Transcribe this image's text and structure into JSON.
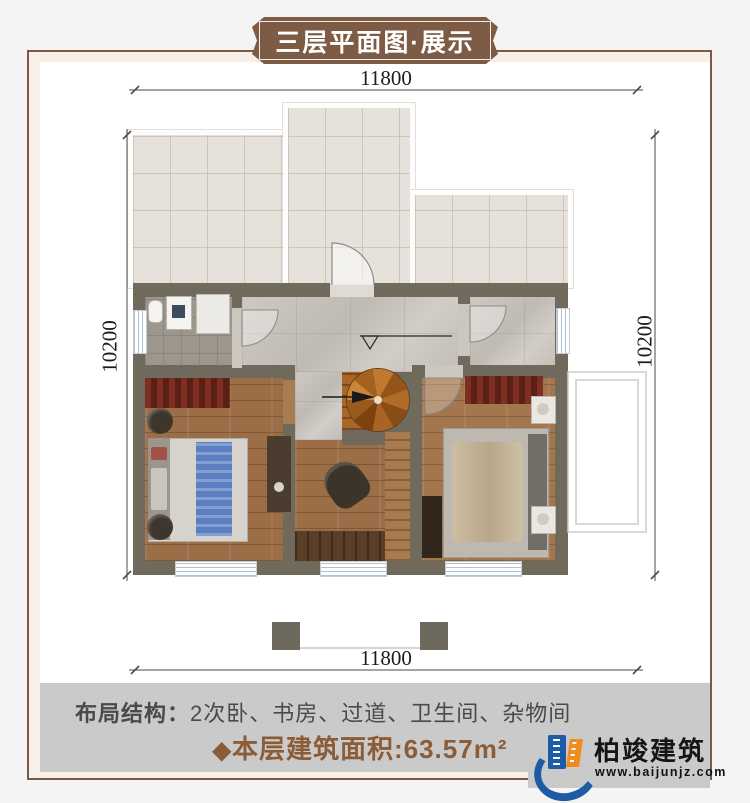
{
  "banner": {
    "title": "三层平面图·展示"
  },
  "dimensions": {
    "top": "11800",
    "bottom": "11800",
    "left": "10200",
    "right": "10200"
  },
  "plan": {
    "elevation": "6.900",
    "stair_label": "下",
    "rooms": [
      {
        "id": "terrace",
        "label": "露台"
      },
      {
        "id": "bathroom",
        "label": "公卫"
      },
      {
        "id": "storage",
        "label": "储藏室"
      },
      {
        "id": "bedroom-left",
        "label": "卧室"
      },
      {
        "id": "bedroom-right",
        "label": "卧室"
      },
      {
        "id": "study",
        "label": "书房"
      }
    ]
  },
  "footer": {
    "layout_label": "布局结构：",
    "layout_value": "2次卧、书房、过道、卫生间、杂物间",
    "area_diamond": "◆",
    "area_label": "本层建筑面积:",
    "area_value": "63.57m²"
  },
  "logo": {
    "name": "柏竣建筑",
    "site": "www.baijunjz.com"
  },
  "colors": {
    "frame_brown": "#7b5a45",
    "banner_brown": "#7d5b44",
    "wall": "#6f6a5c",
    "area_text_brown": "#8a5c38",
    "bar_gray": "#cacaca",
    "logo_blue": "#1d5ba6",
    "logo_orange": "#f08c1e"
  }
}
